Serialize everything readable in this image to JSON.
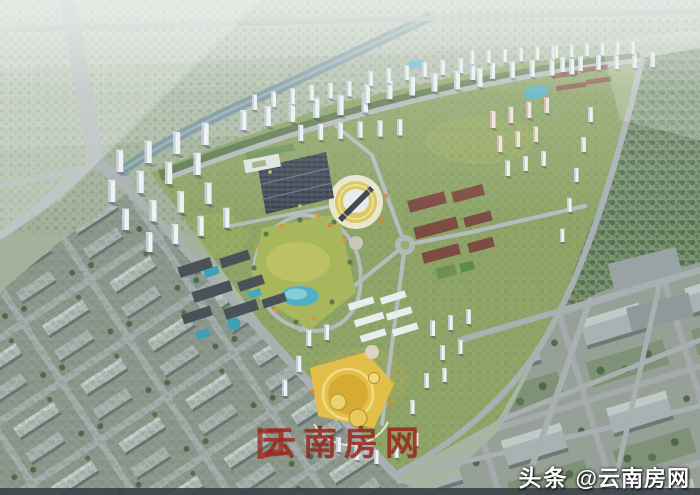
{
  "image": {
    "kind": "aerial-architectural-rendering",
    "description": "Bird's-eye CGI masterplan rendering: a large triangular residential development with arcs of white high-rise towers, a central park with pond, an oval landscaped plaza, school campuses with pools, a red-brick campus, and a golden commercial center, surrounded by gray city blocks, farmland haze and forest",
    "width_px": 700,
    "height_px": 495
  },
  "watermarks": {
    "center": {
      "logo": "yunnan-fangwang-logo",
      "text": "云南房网",
      "color": "#a0281e"
    },
    "bottom_right": {
      "prefix": "头条",
      "handle": "@云南房网",
      "color": "#ffffff"
    }
  },
  "palette": {
    "haze_green": "#b7c2b4",
    "field_green": "#a2b29b",
    "forest_green": "#7d9474",
    "road_gray": "#a9b0b2",
    "tower_white": "#eef2f4",
    "block_gray": "#b2bbba",
    "park_yellow_green": "#b9bd62",
    "pond_blue": "#4fb0c6",
    "gold_accent": "#e3bf49",
    "red_campus": "#7d4b41",
    "river_blue_gray": "#74909b"
  },
  "scene": {
    "regions": [
      "hazy-farmland-north",
      "river",
      "forest-east",
      "north-tower-arc",
      "west-tower-cluster",
      "east-tower-cluster",
      "south-tower-cluster",
      "central-oval-plaza",
      "parking-array",
      "central-park-pond",
      "campus-with-pools",
      "red-brick-campus",
      "golden-commercial-center",
      "old-town-grid-southwest",
      "industrial-grid-southeast",
      "roundabout"
    ]
  }
}
